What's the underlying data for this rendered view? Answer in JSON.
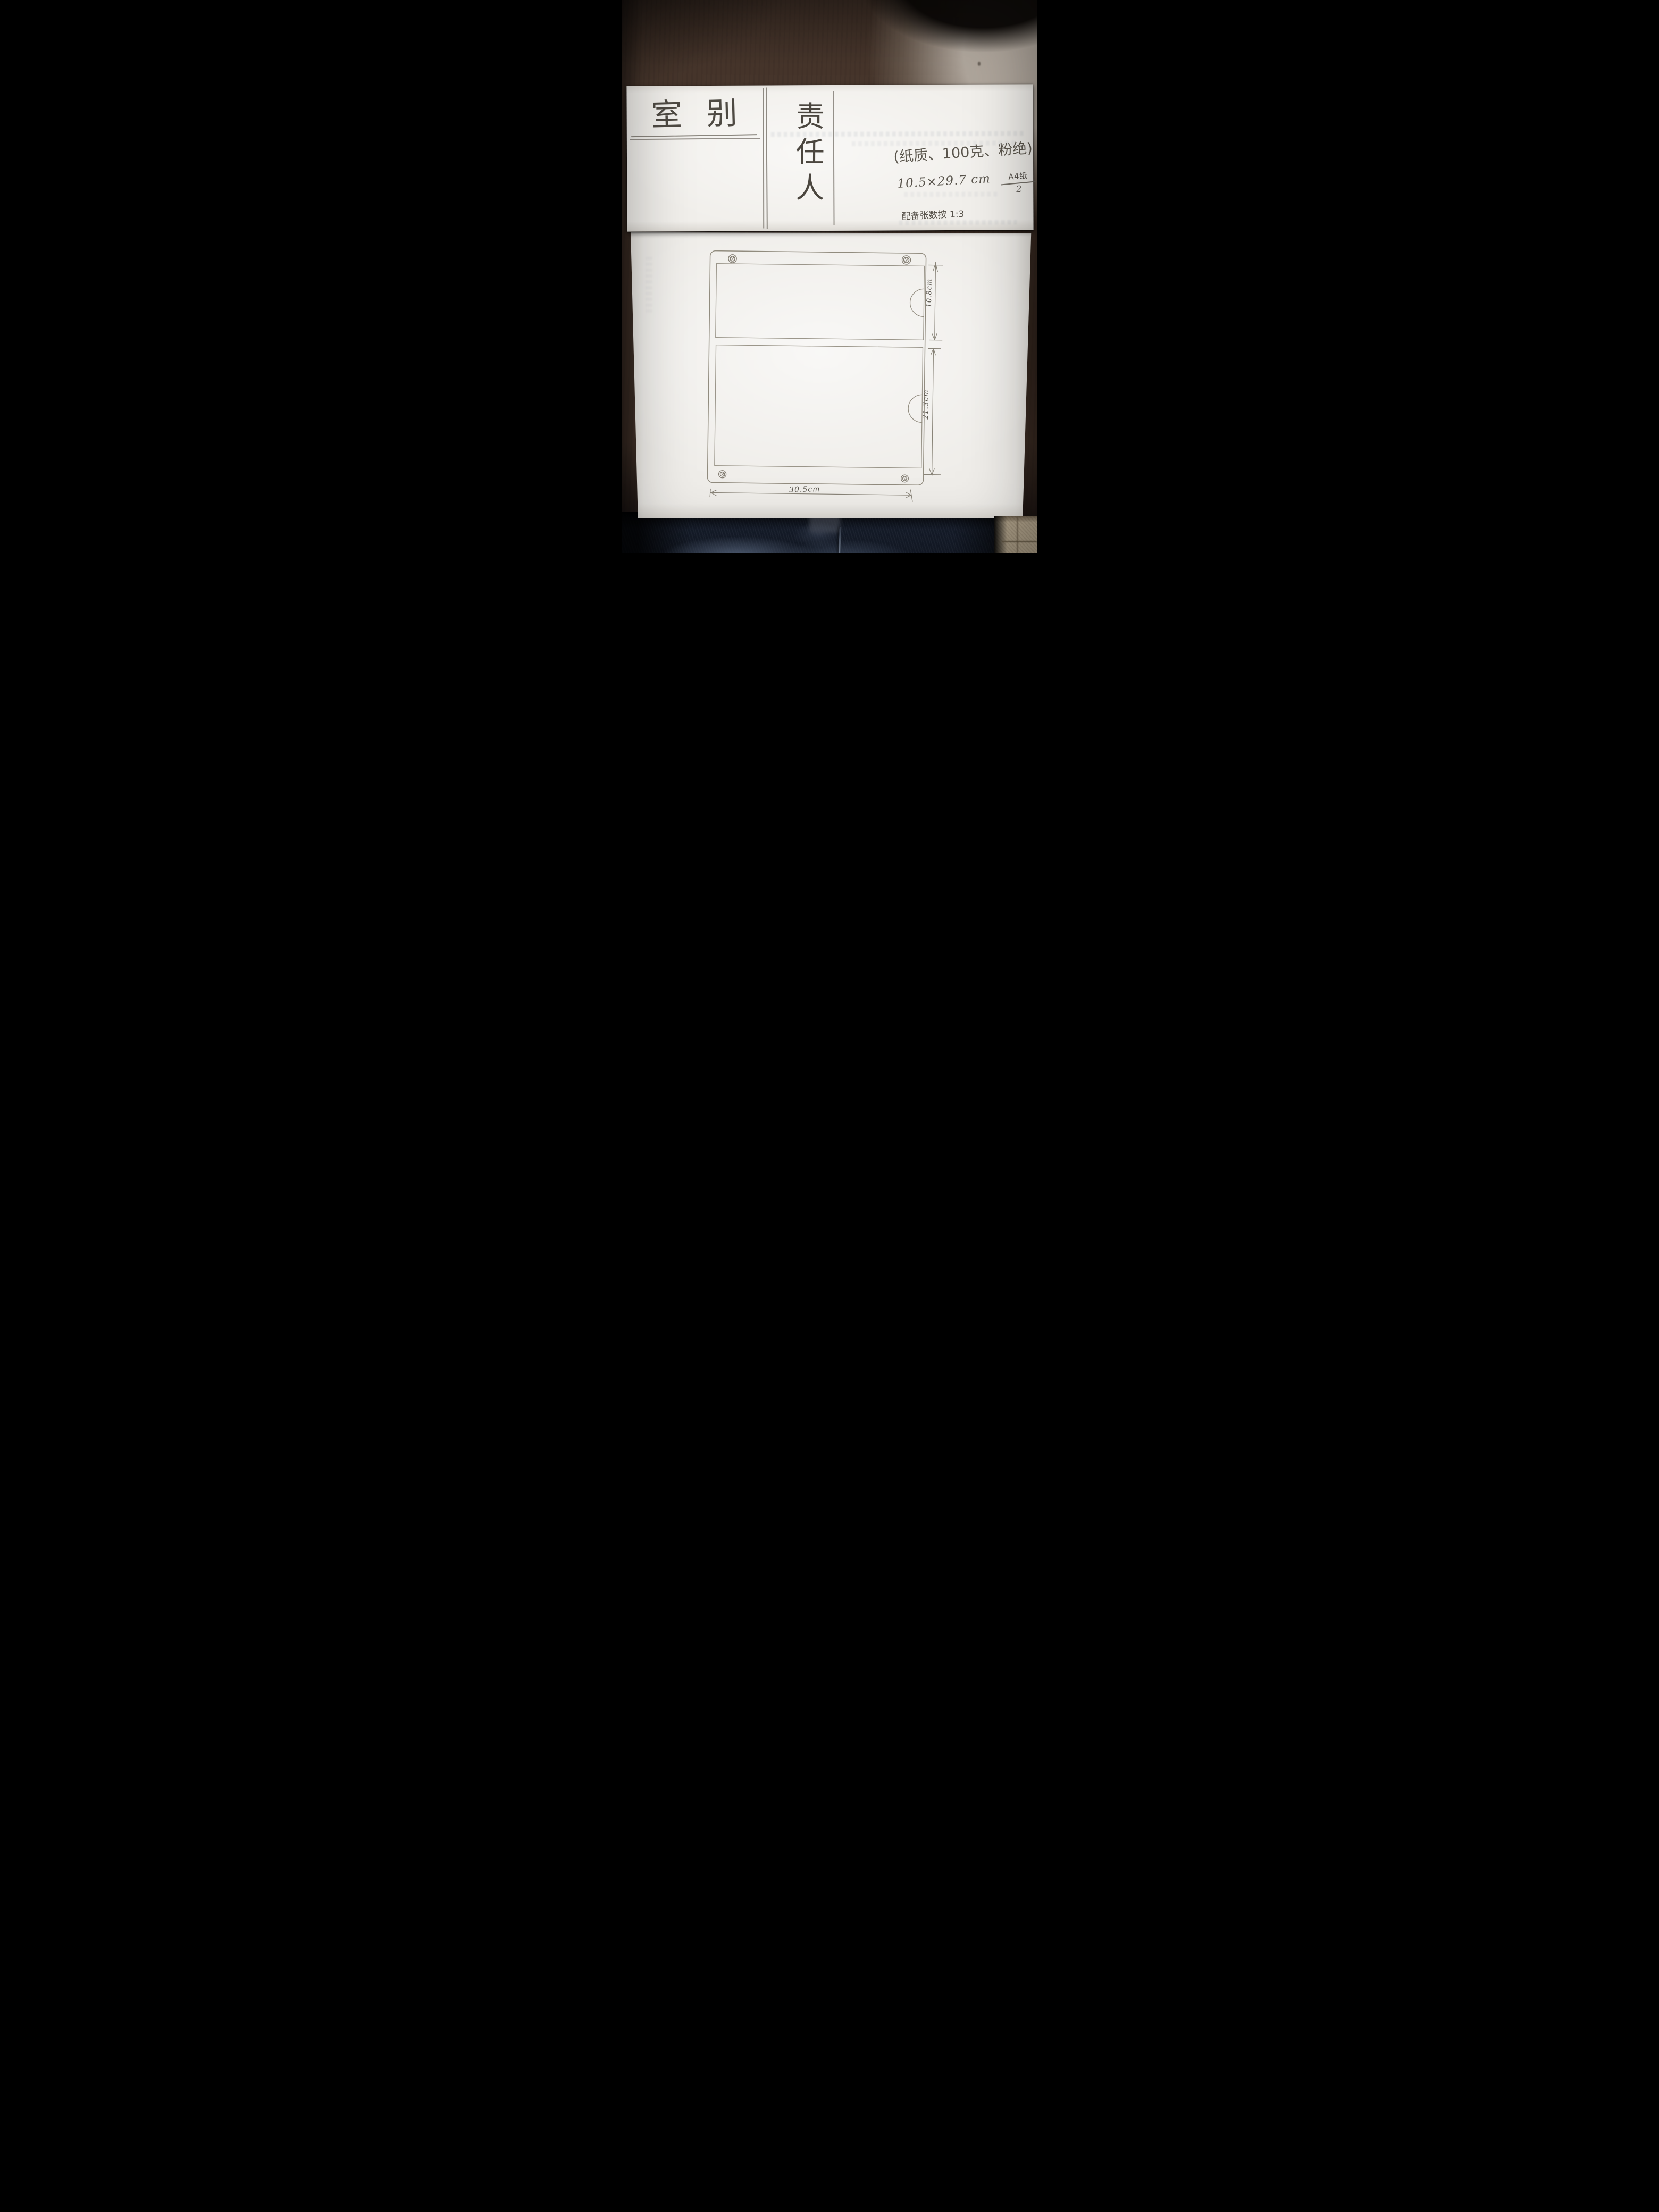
{
  "top_strip": {
    "room_label": "室别",
    "responsible_label": "责任人",
    "paper_note": "(纸质、100克、粉绝)",
    "size_note": "10.5×29.7 cm",
    "fraction": {
      "numerator": "A4纸",
      "denominator": "2"
    },
    "ratio_note": "配备张数按 1:3"
  },
  "drawing": {
    "type": "hand-drawn panel sketch with corner screws and two sections",
    "width_label": "30.5cm",
    "sections": [
      {
        "name": "top",
        "height_label": "10.8cm"
      },
      {
        "name": "bottom",
        "height_label": "21.3cm"
      }
    ],
    "screw_count": 4,
    "notch_count": 2
  },
  "colors": {
    "wood": "#46352b",
    "wood_light": "#a89e94",
    "paper": "#f1efeb",
    "graphite": "#5f5a51",
    "line": "#8c8679",
    "denim": "#161d2b",
    "denim_light": "#64748f",
    "tile": "#b2a48c"
  }
}
